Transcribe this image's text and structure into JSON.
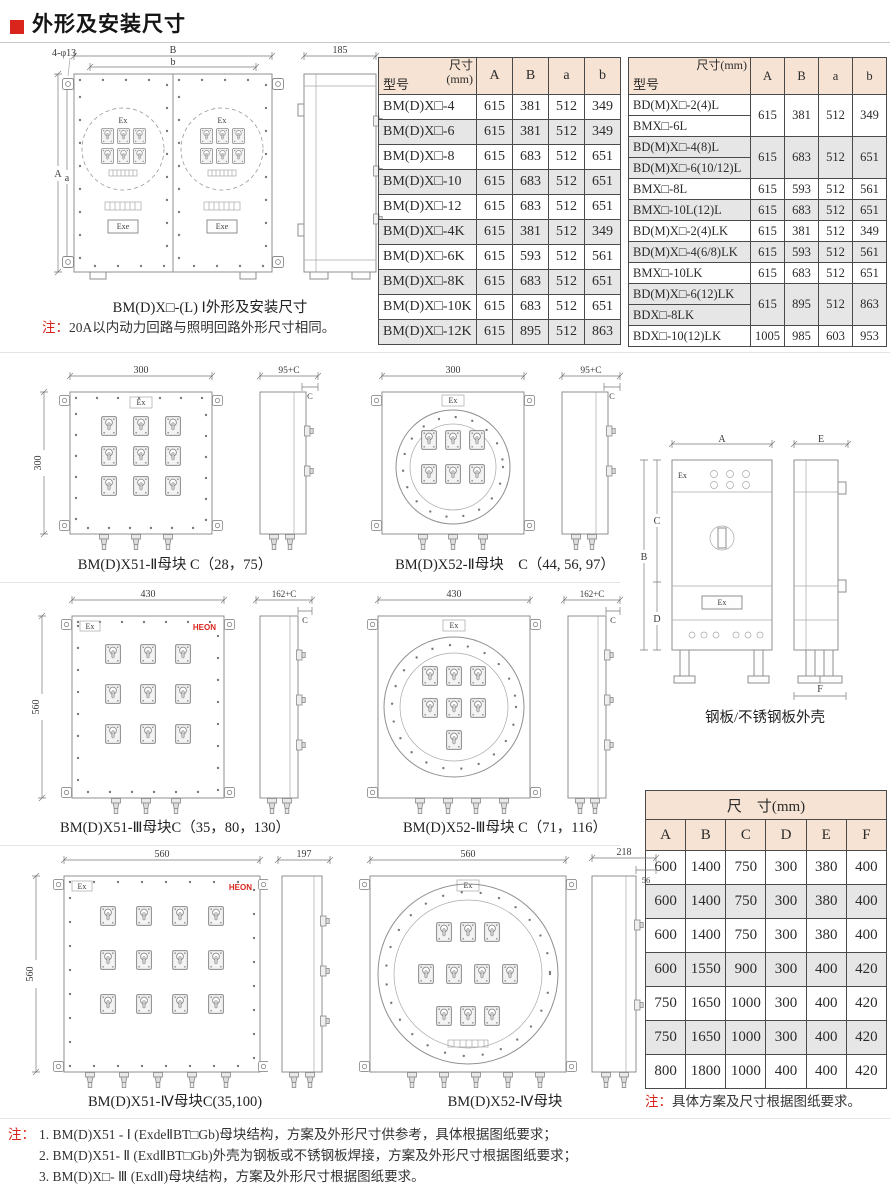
{
  "header": {
    "title": "外形及安装尺寸"
  },
  "colors": {
    "accent_red": "#d9251c",
    "table_header_bg": "#f6e3d3",
    "row_alt_bg": "#e6e6e6"
  },
  "labels": {
    "ex": "Ex",
    "exe": "Exe",
    "heon": "HEON"
  },
  "s1": {
    "dims": {
      "holes": "4-φ13",
      "B": "B",
      "b": "b",
      "A": "A",
      "a": "a",
      "side": "185"
    },
    "caption": "BM(D)X□-(L) Ⅰ外形及安装尺寸",
    "note_prefix": "注：",
    "note": "20A以内动力回路与照明回路外形尺寸相同。",
    "table1": {
      "diag_top": "尺寸",
      "diag_top2": "(mm)",
      "diag_bottom": "型号",
      "cols": [
        "A",
        "B",
        "a",
        "b"
      ],
      "rows": [
        [
          "BM(D)X□-4",
          "615",
          "381",
          "512",
          "349"
        ],
        [
          "BM(D)X□-6",
          "615",
          "381",
          "512",
          "349"
        ],
        [
          "BM(D)X□-8",
          "615",
          "683",
          "512",
          "651"
        ],
        [
          "BM(D)X□-10",
          "615",
          "683",
          "512",
          "651"
        ],
        [
          "BM(D)X□-12",
          "615",
          "683",
          "512",
          "651"
        ],
        [
          "BM(D)X□-4K",
          "615",
          "381",
          "512",
          "349"
        ],
        [
          "BM(D)X□-6K",
          "615",
          "593",
          "512",
          "561"
        ],
        [
          "BM(D)X□-8K",
          "615",
          "683",
          "512",
          "651"
        ],
        [
          "BM(D)X□-10K",
          "615",
          "683",
          "512",
          "651"
        ],
        [
          "BM(D)X□-12K",
          "615",
          "895",
          "512",
          "863"
        ]
      ]
    },
    "table2": {
      "diag_top": "尺寸(mm)",
      "diag_bottom": "型号",
      "cols": [
        "A",
        "B",
        "a",
        "b"
      ],
      "groups": [
        {
          "models": [
            "BD(M)X□-2(4)L",
            "BMX□-6L"
          ],
          "values": [
            "615",
            "381",
            "512",
            "349"
          ]
        },
        {
          "models": [
            "BD(M)X□-4(8)L",
            "BD(M)X□-6(10/12)L"
          ],
          "values": [
            "615",
            "683",
            "512",
            "651"
          ]
        },
        {
          "models": [
            "BMX□-8L"
          ],
          "values": [
            "615",
            "593",
            "512",
            "561"
          ]
        },
        {
          "models": [
            "BMX□-10L(12)L"
          ],
          "values": [
            "615",
            "683",
            "512",
            "651"
          ]
        },
        {
          "models": [
            "BD(M)X□-2(4)LK"
          ],
          "values": [
            "615",
            "381",
            "512",
            "349"
          ]
        },
        {
          "models": [
            "BD(M)X□-4(6/8)LK"
          ],
          "values": [
            "615",
            "593",
            "512",
            "561"
          ]
        },
        {
          "models": [
            "BMX□-10LK"
          ],
          "values": [
            "615",
            "683",
            "512",
            "651"
          ]
        },
        {
          "models": [
            "BD(M)X□-6(12)LK",
            "BDX□-8LK"
          ],
          "values": [
            "615",
            "895",
            "512",
            "863"
          ]
        },
        {
          "models": [
            "BDX□-10(12)LK"
          ],
          "values": [
            "1005",
            "985",
            "603",
            "953"
          ]
        }
      ]
    }
  },
  "s2": {
    "left": {
      "dim_w": "300",
      "dim_h": "300",
      "dim_side": "95+C",
      "dim_c": "C",
      "caption": "BM(D)X51-Ⅱ母块 C（28，75）"
    },
    "right": {
      "dim_w": "300",
      "dim_side": "95+C",
      "dim_c": "C",
      "caption": "BM(D)X52-Ⅱ母块　C（44, 56, 97）"
    }
  },
  "s3": {
    "left": {
      "dim_w": "430",
      "dim_h": "560",
      "dim_side": "162+C",
      "dim_c": "C",
      "caption": "BM(D)X51-Ⅲ母块C（35，80，130）"
    },
    "right": {
      "dim_w": "430",
      "dim_side": "162+C",
      "dim_c": "C",
      "caption": "BM(D)X52-Ⅲ母块 C（71，116）"
    }
  },
  "s4": {
    "left": {
      "dim_w": "560",
      "dim_h": "560",
      "dim_side": "197",
      "caption": "BM(D)X51-Ⅳ母块C(35,100)"
    },
    "right": {
      "dim_w": "560",
      "dim_side": "218",
      "dim_sub": "56",
      "caption": "BM(D)X52-Ⅳ母块"
    }
  },
  "cabinet": {
    "dims": {
      "A": "A",
      "B": "B",
      "C": "C",
      "D": "D",
      "E": "E",
      "F": "F"
    },
    "caption": "钢板/不锈钢板外壳",
    "table": {
      "title": "尺　寸(mm)",
      "cols": [
        "A",
        "B",
        "C",
        "D",
        "E",
        "F"
      ],
      "rows": [
        [
          "600",
          "1400",
          "750",
          "300",
          "380",
          "400"
        ],
        [
          "600",
          "1400",
          "750",
          "300",
          "380",
          "400"
        ],
        [
          "600",
          "1400",
          "750",
          "300",
          "380",
          "400"
        ],
        [
          "600",
          "1550",
          "900",
          "300",
          "400",
          "420"
        ],
        [
          "750",
          "1650",
          "1000",
          "300",
          "400",
          "420"
        ],
        [
          "750",
          "1650",
          "1000",
          "300",
          "400",
          "420"
        ],
        [
          "800",
          "1800",
          "1000",
          "400",
          "400",
          "420"
        ]
      ],
      "note_prefix": "注：",
      "note": "具体方案及尺寸根据图纸要求。"
    }
  },
  "footnotes": {
    "prefix": "注：",
    "lines": [
      "1. BM(D)X51 - Ⅰ (ExdeⅡBT□Gb)母块结构，方案及外形尺寸供参考，具体根据图纸要求；",
      "2. BM(D)X51- Ⅱ (ExdⅡBT□Gb)外壳为钢板或不锈钢板焊接，方案及外形尺寸根据图纸要求；",
      "3. BM(D)X□- Ⅲ (ExdⅡ)母块结构，方案及外形尺寸根据图纸要求。"
    ]
  }
}
